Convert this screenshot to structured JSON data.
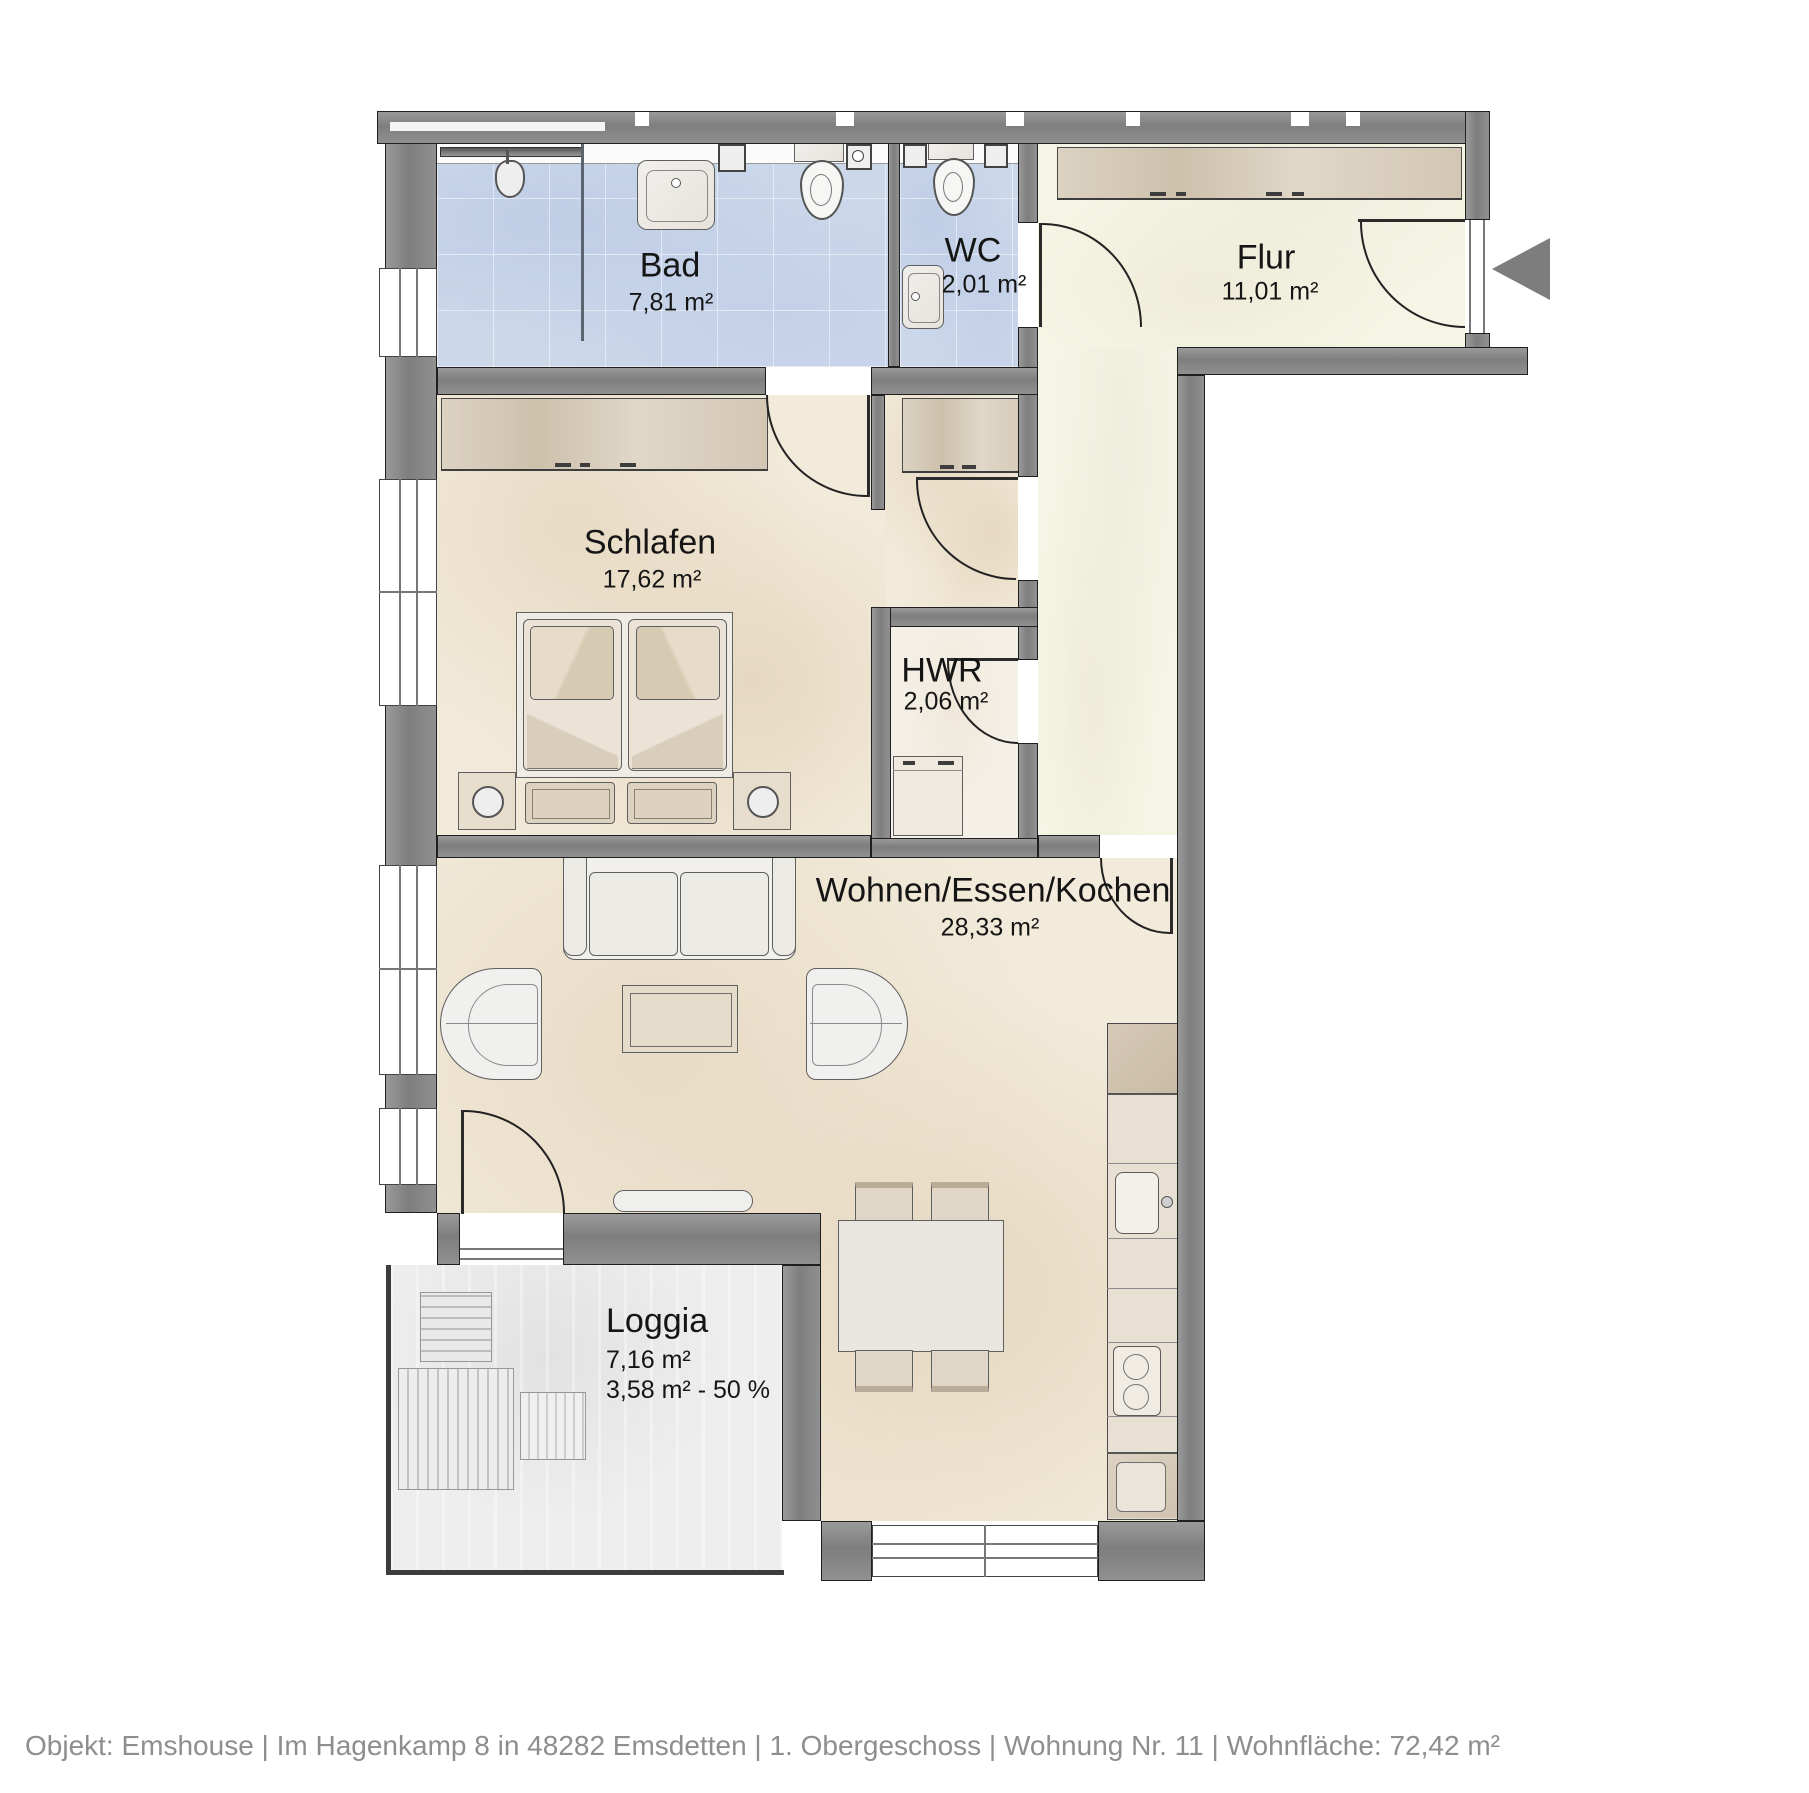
{
  "plan": {
    "type": "apartment-floor-plan",
    "rooms": [
      {
        "id": "bad",
        "name": "Bad",
        "area": "7,81 m²"
      },
      {
        "id": "wc",
        "name": "WC",
        "area": "2,01 m²"
      },
      {
        "id": "flur",
        "name": "Flur",
        "area": "11,01 m²"
      },
      {
        "id": "schlafen",
        "name": "Schlafen",
        "area": "17,62 m²"
      },
      {
        "id": "hwr",
        "name": "HWR",
        "area": "2,06 m²"
      },
      {
        "id": "wohnen",
        "name": "Wohnen/Essen/Kochen",
        "area": "28,33 m²"
      },
      {
        "id": "loggia",
        "name": "Loggia",
        "area": "7,16 m²",
        "area_half": "3,58 m² - 50 %"
      }
    ],
    "colors": {
      "wall": "#8a8a8a",
      "bath_floor": "#ccd8ea",
      "living_floor": "#f2ebdb",
      "hall_floor": "#f6f4e4",
      "loggia_floor": "#eeeeee",
      "outline": "#1f1f1f",
      "entrance_arrow": "#7d7d7d",
      "footer_text": "#8e8e8e"
    },
    "icons": [
      "entrance-arrow-icon"
    ]
  },
  "footer": {
    "text": "Objekt: Emshouse | Im Hagenkamp 8 in 48282 Emsdetten | 1. Obergeschoss | Wohnung Nr. 11 | Wohnfläche: 72,42 m²"
  }
}
